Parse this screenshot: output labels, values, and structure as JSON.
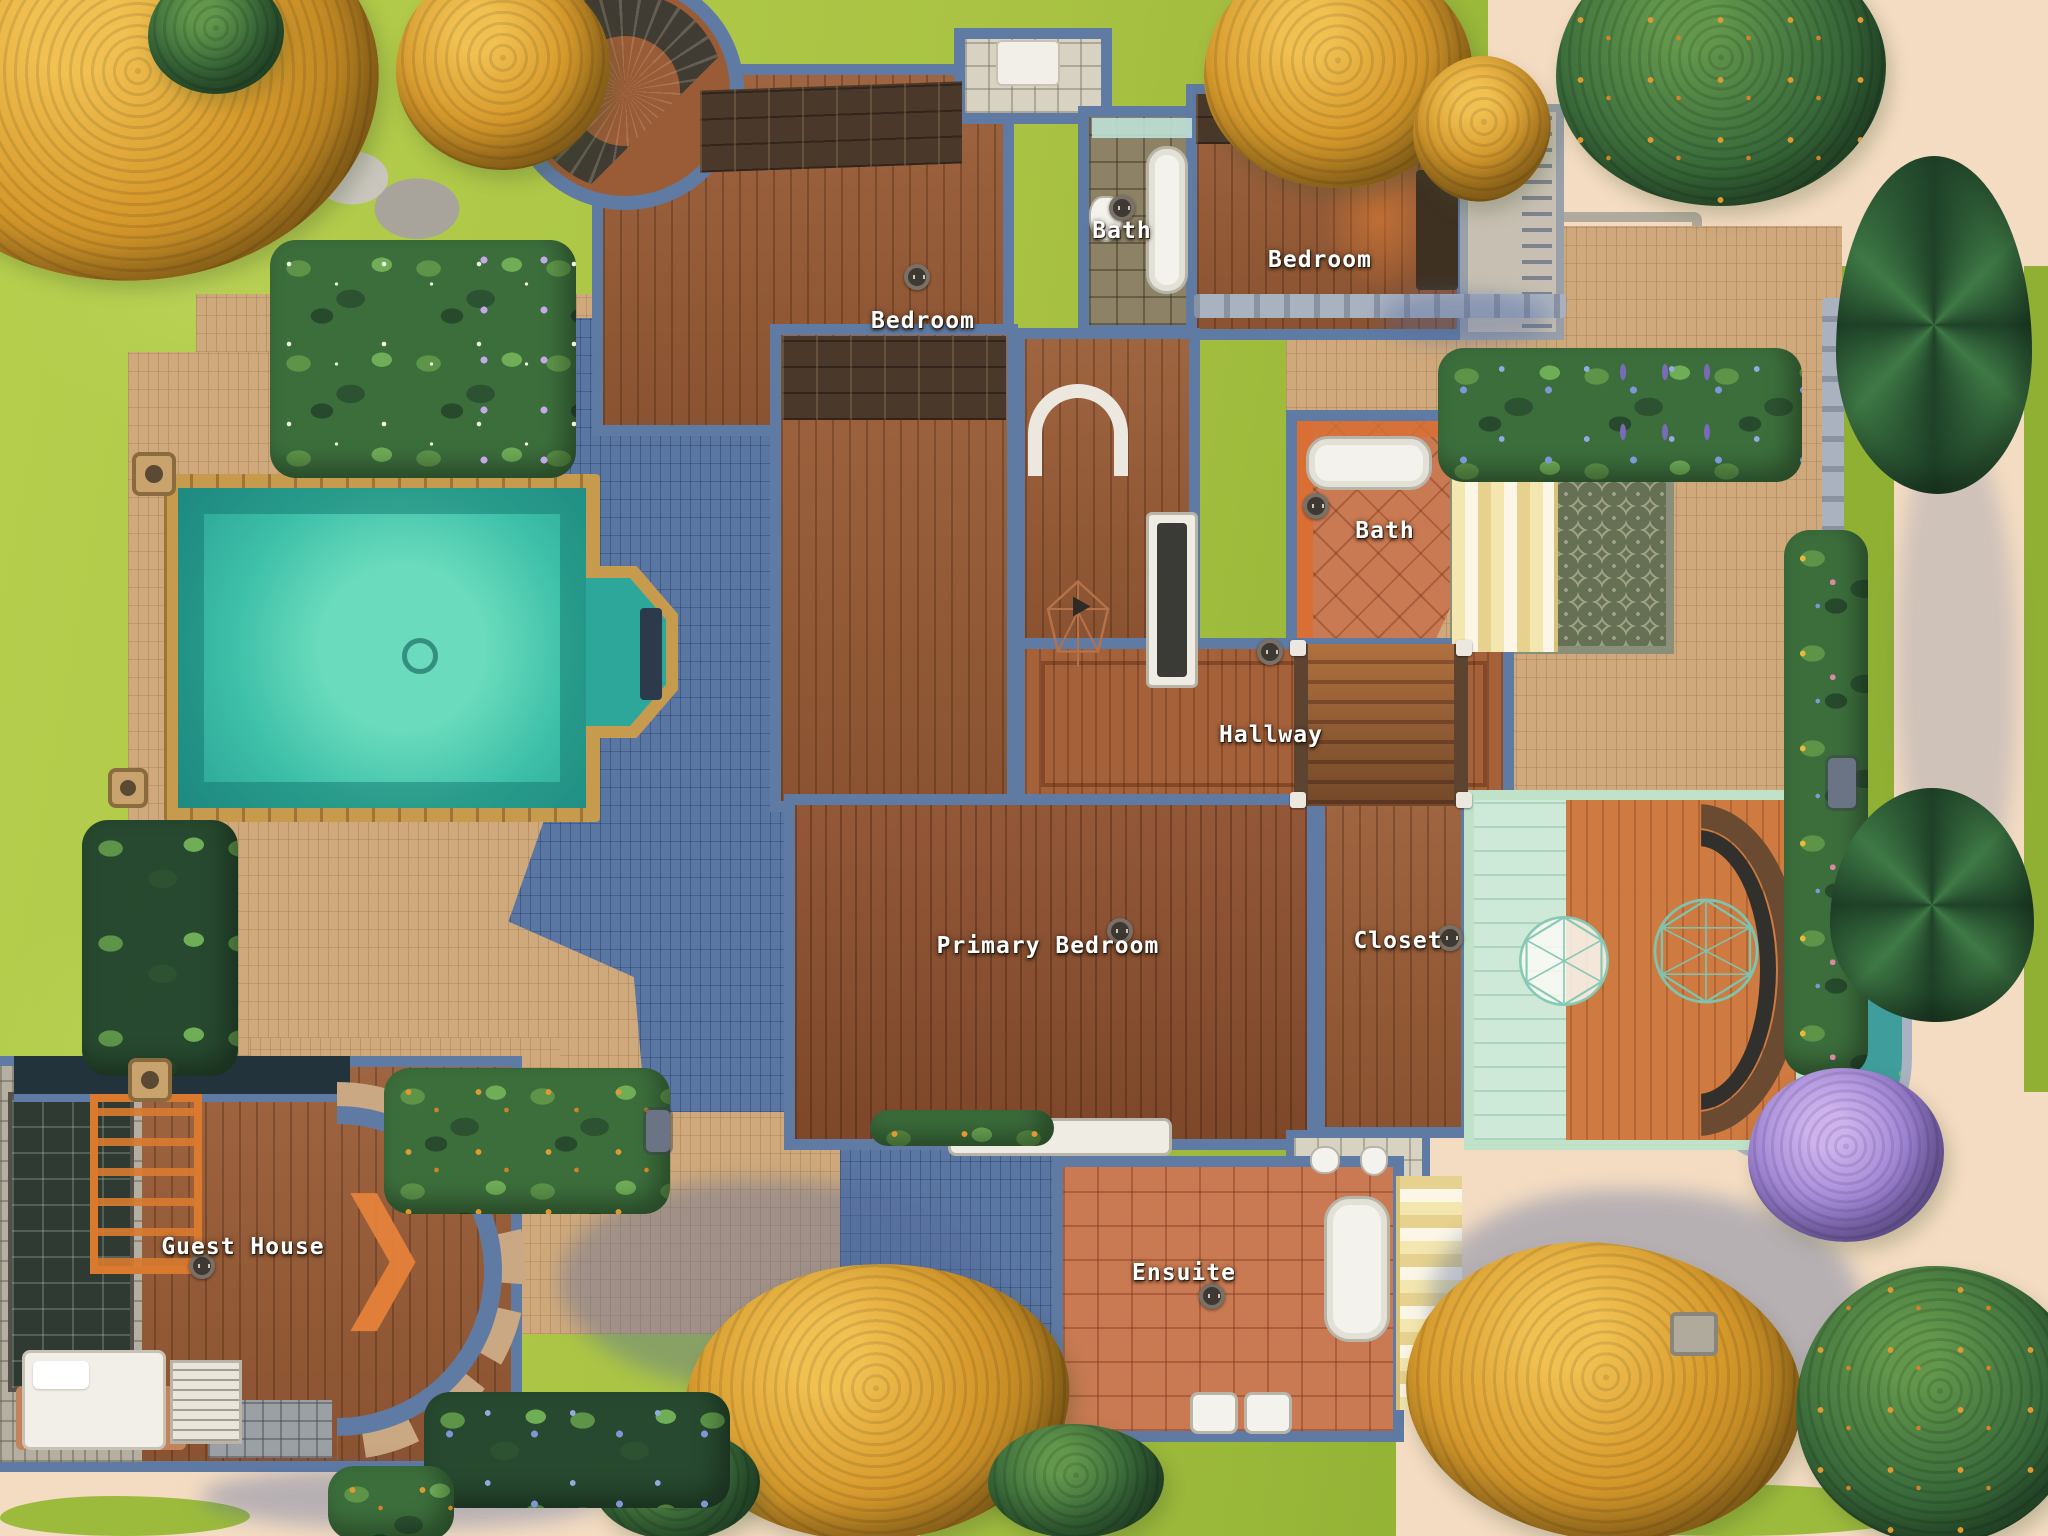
{
  "labels": {
    "bath_top": "Bath",
    "bedroom_left": "Bedroom",
    "bedroom_right": "Bedroom",
    "bath_middle": "Bath",
    "hallway": "Hallway",
    "primary_bedroom": "Primary Bedroom",
    "closet": "Closet",
    "ensuite": "Ensuite",
    "guest_house": "Guest House"
  },
  "icons": {
    "direction_chevron": "❯",
    "floor_outlet": "outlet-circle"
  },
  "palette": {
    "grass": "#a9c243",
    "path": "#f4dcc2",
    "terrace": "#cfa97b",
    "slate": "#5a76a2",
    "wall": "#5f7ba4",
    "wood": "#9a5c36",
    "wood_dark": "#8f5130",
    "water": "#3cbfa8",
    "gold": "#c79b4e",
    "terracotta": "#c97a52",
    "mint": "#bfe2c9",
    "awning": "#f3e6ae",
    "autumn": "#d79a2c",
    "evergreen": "#2e5b38",
    "lilac": "#9b7fd4",
    "hydrangea": "#7f97d8",
    "label_text": "#ffffff"
  }
}
